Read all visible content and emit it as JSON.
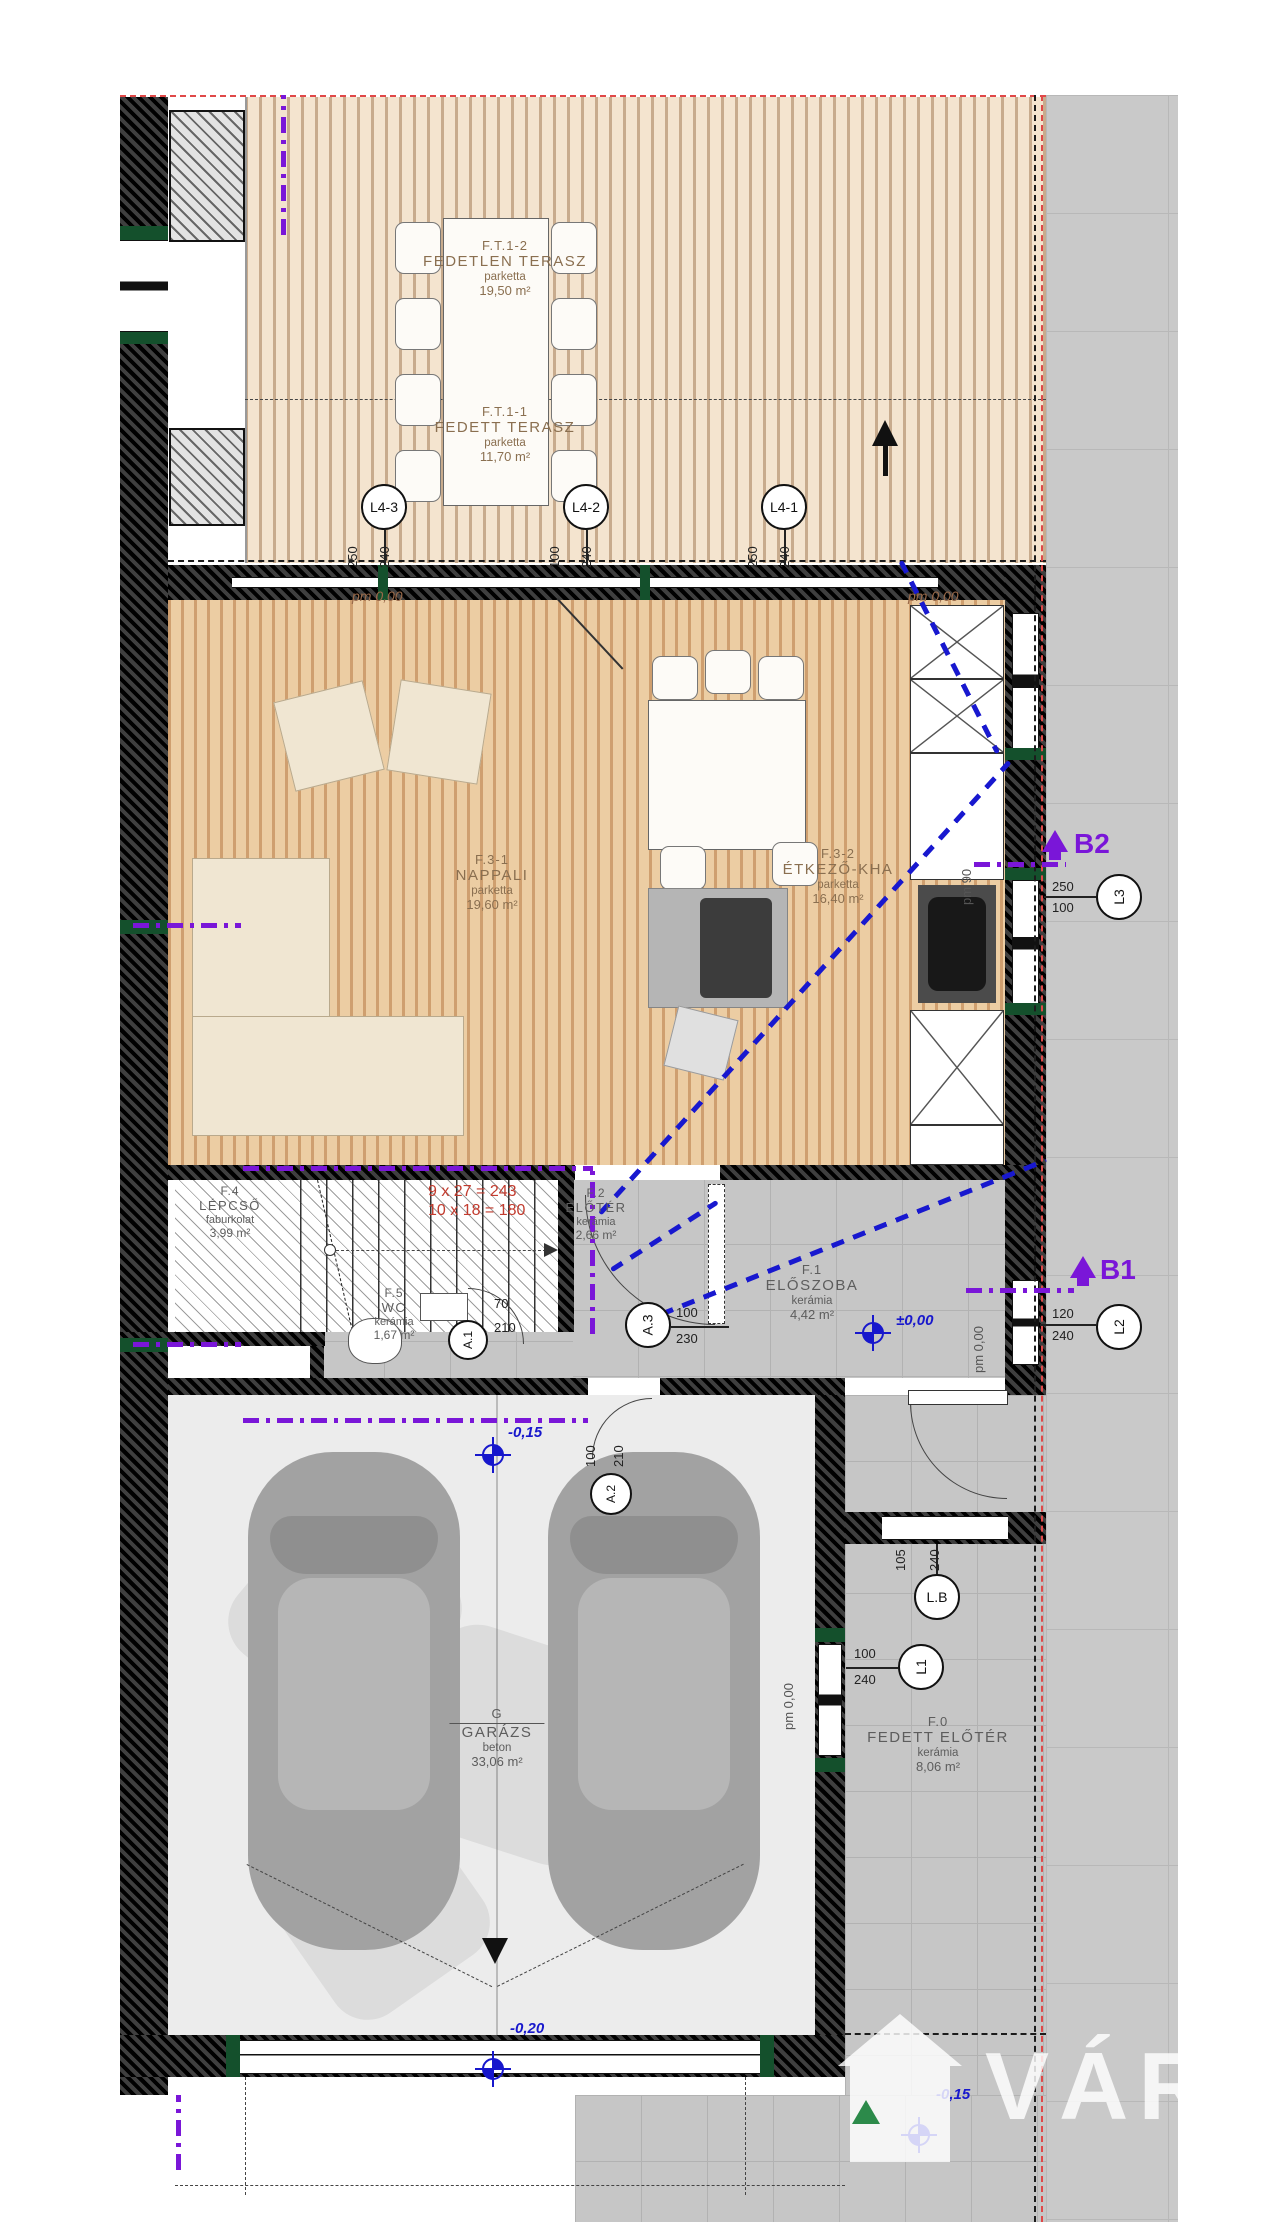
{
  "rooms": {
    "ft12": {
      "id": "F.T.1-2",
      "name": "FEDETLEN TERASZ",
      "finish": "parketta",
      "area": "19,50 m²"
    },
    "ft11": {
      "id": "F.T.1-1",
      "name": "FEDETT TERASZ",
      "finish": "parketta",
      "area": "11,70 m²"
    },
    "f31": {
      "id": "F.3-1",
      "name": "NAPPALI",
      "finish": "parketta",
      "area": "19,60 m²"
    },
    "f32": {
      "id": "F.3-2",
      "name": "ÉTKEZŐ-KHA",
      "finish": "parketta",
      "area": "16,40 m²"
    },
    "f4": {
      "id": "F.4",
      "name": "LÉPCSŐ",
      "finish": "faburkolat",
      "area": "3,99 m²"
    },
    "f2": {
      "id": "F.2",
      "name": "ELŐTÉR",
      "finish": "kerámia",
      "area": "2,66 m²"
    },
    "f5": {
      "id": "F.5",
      "name": "WC",
      "finish": "kerámia",
      "area": "1,67 m²"
    },
    "f1": {
      "id": "F.1",
      "name": "ELŐSZOBA",
      "finish": "kerámia",
      "area": "4,42 m²"
    },
    "g": {
      "id": "G",
      "name": "GARÁZS",
      "finish": "beton",
      "area": "33,06 m²"
    },
    "f0": {
      "id": "F.0",
      "name": "FEDETT ELŐTÉR",
      "finish": "kerámia",
      "area": "8,06 m²"
    }
  },
  "markers": {
    "l43": {
      "label": "L4-3",
      "w": "250",
      "h": "240"
    },
    "l42": {
      "label": "L4-2",
      "w": "100",
      "h": "240"
    },
    "l41": {
      "label": "L4-1",
      "w": "250",
      "h": "240"
    },
    "l3": {
      "label": "L3",
      "w": "250",
      "h": "100"
    },
    "l2": {
      "label": "L2",
      "w": "120",
      "h": "240"
    },
    "l1": {
      "label": "L1",
      "w": "100",
      "h": "240"
    },
    "lb": {
      "label": "L.B",
      "w": "105",
      "h": "240"
    },
    "a3": {
      "label": "A.3",
      "w": "100",
      "h": "230"
    },
    "a1": {
      "label": "A.1",
      "w": "70",
      "h": "210"
    },
    "a2": {
      "label": "A.2",
      "w": "100",
      "h": "210"
    }
  },
  "sections": {
    "b1": "B1",
    "b2": "B2"
  },
  "levels": {
    "pm_zero": "pm 0,00",
    "pm_90": "pm 90",
    "zero": "±0,00",
    "minus015": "-0,15",
    "minus020": "-0,20"
  },
  "stairs": {
    "calc1": "9 x 27 = 243",
    "calc2": "10 x 18 = 180"
  },
  "watermark": {
    "text": "VÁROS"
  }
}
